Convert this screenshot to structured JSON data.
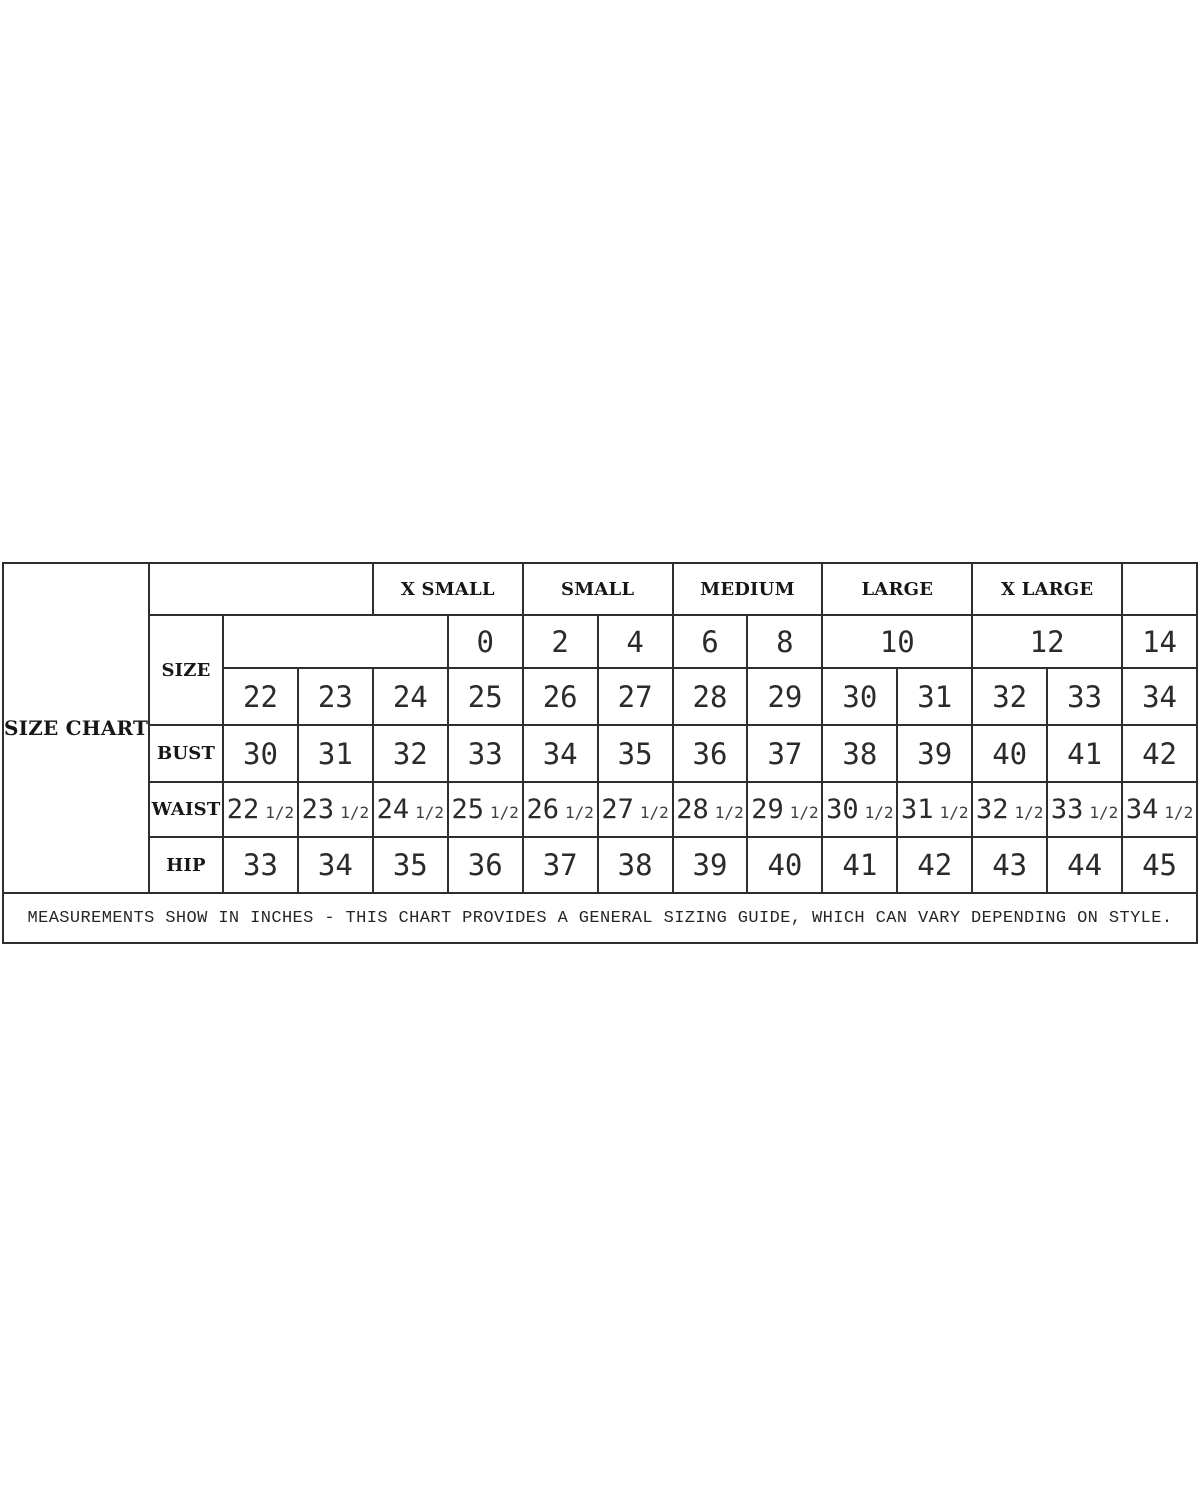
{
  "display": {
    "row_labels": {
      "size": "SIZE",
      "bust": "BUST",
      "waist": "WAIST",
      "hip": "HIP"
    },
    "waist_whole": [
      22,
      23,
      24,
      25,
      26,
      27,
      28,
      29,
      30,
      31,
      32,
      33,
      34
    ],
    "fraction": "1/2"
  },
  "chart_data": {
    "type": "table",
    "title": "SIZE CHART",
    "size_group_headers": [
      "X SMALL",
      "SMALL",
      "MEDIUM",
      "LARGE",
      "X LARGE"
    ],
    "row_headers": [
      "SIZE",
      "BUST",
      "WAIST",
      "HIP"
    ],
    "size_us": [
      0,
      2,
      4,
      6,
      8,
      10,
      12,
      14
    ],
    "size_secondary": [
      22,
      23,
      24,
      25,
      26,
      27,
      28,
      29,
      30,
      31,
      32,
      33,
      34
    ],
    "bust_inches": [
      30,
      31,
      32,
      33,
      34,
      35,
      36,
      37,
      38,
      39,
      40,
      41,
      42
    ],
    "waist_inches": [
      22.5,
      23.5,
      24.5,
      25.5,
      26.5,
      27.5,
      28.5,
      29.5,
      30.5,
      31.5,
      32.5,
      33.5,
      34.5
    ],
    "hip_inches": [
      33,
      34,
      35,
      36,
      37,
      38,
      39,
      40,
      41,
      42,
      43,
      44,
      45
    ],
    "units_note": "MEASUREMENTS SHOW IN INCHES - THIS CHART PROVIDES A GENERAL SIZING GUIDE, WHICH CAN VARY DEPENDING ON STYLE."
  }
}
